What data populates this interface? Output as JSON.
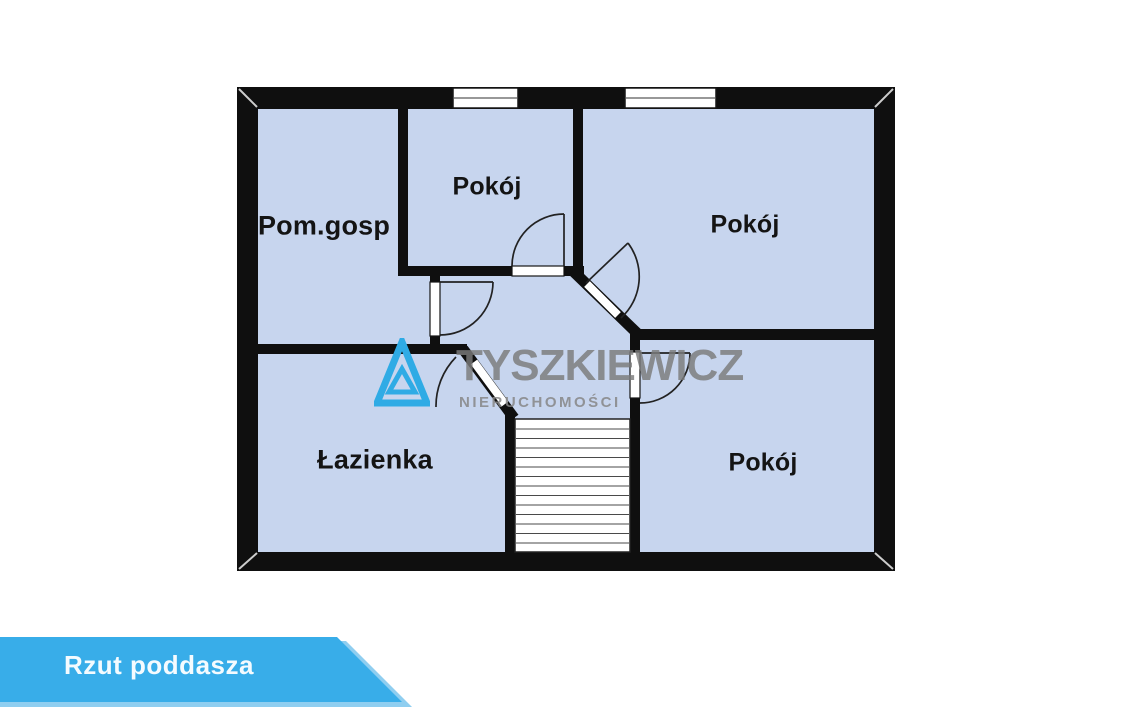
{
  "floorplan": {
    "rooms": [
      {
        "id": "pom-gosp",
        "label": "Pom.gosp"
      },
      {
        "id": "pokoj-top-middle",
        "label": "Pokój"
      },
      {
        "id": "pokoj-top-right",
        "label": "Pokój"
      },
      {
        "id": "lazienka",
        "label": "Łazienka"
      },
      {
        "id": "pokoj-bottom-right",
        "label": "Pokój"
      }
    ],
    "colors": {
      "wall": "#0f0f0f",
      "room_fill": "#c7d5ee",
      "window": "#ffffff"
    }
  },
  "watermark": {
    "brand": "TYSZKIEWICZ",
    "subtitle": "NIERUCHOMOŚCI",
    "logo_color": "#2fabe5",
    "text_color": "#7b7b7b"
  },
  "banner": {
    "label": "Rzut poddasza",
    "color": "#38ade9",
    "accent_color": "#8fcef0",
    "text_color": "#f4fbff"
  }
}
